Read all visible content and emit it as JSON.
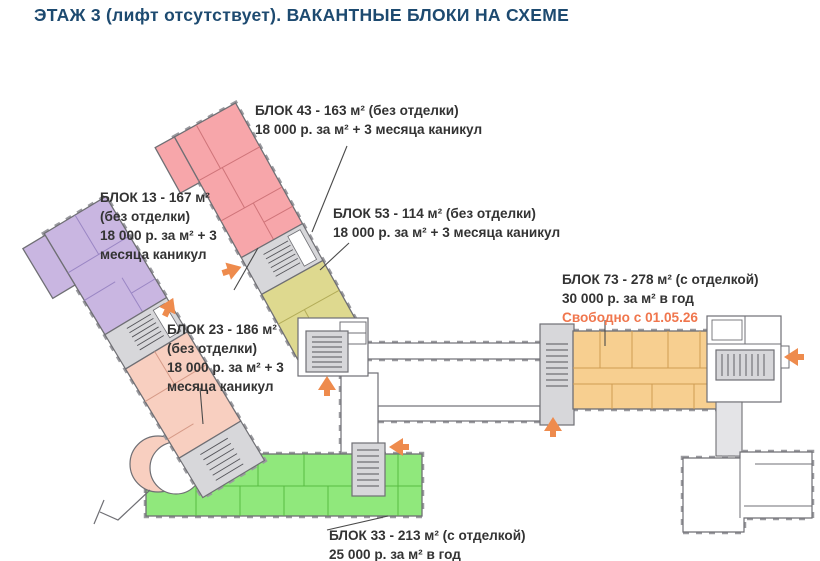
{
  "title": "ЭТАЖ 3 (лифт отсутствует). ВАКАНТНЫЕ БЛОКИ НА СХЕМЕ",
  "colors": {
    "title_text": "#1d4a70",
    "label_text": "#333333",
    "availability_text": "#f0764d",
    "arrow": "#ee8b4d",
    "wall": "#6f6f74",
    "stair_fill": "#d7d7da",
    "block13_fill": "#c9b6e1",
    "block23_fill": "#f8cfc0",
    "block33_fill": "#90e87c",
    "block43_fill": "#f7a6aa",
    "block53_fill": "#ded98f",
    "block73_fill": "#f7cf90"
  },
  "labels": {
    "block43": {
      "name": "БЛОК 43 - 163 м² (без отделки)",
      "terms": "18 000 р. за м² + 3 месяца каникул"
    },
    "block13": {
      "line1": "БЛОК 13 - 167 м²",
      "line2": "(без отделки)",
      "line3": "18 000 р. за м² + 3",
      "line4": "месяца каникул"
    },
    "block53": {
      "name": "БЛОК 53 - 114 м² (без отделки)",
      "terms": "18 000 р. за м² + 3 месяца каникул"
    },
    "block23": {
      "line1": "БЛОК 23 - 186 м²",
      "line2": "(без отделки)",
      "line3": "18 000 р. за м² + 3",
      "line4": "месяца каникул"
    },
    "block73": {
      "name": "БЛОК 73 - 278 м² (с отделкой)",
      "terms": "30 000 р. за м² в год",
      "availability": "Свободно с 01.05.26"
    },
    "block33": {
      "name": "БЛОК 33 - 213 м² (с отделкой)",
      "terms": "25 000 р. за м² в год"
    }
  }
}
